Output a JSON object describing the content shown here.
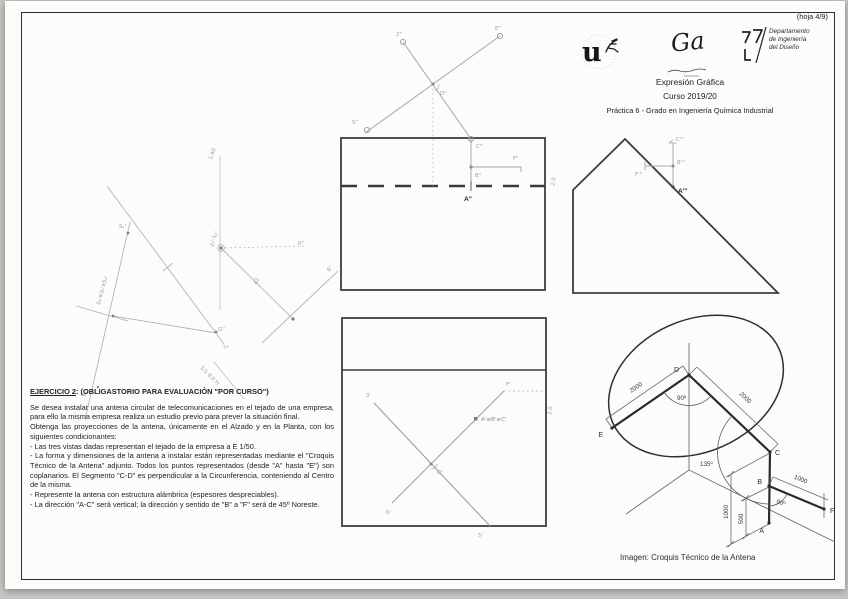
{
  "page": {
    "hoja": "(hoja 4/9)"
  },
  "header": {
    "uni_glyph": "u",
    "mid_glyph": "Ga",
    "dept_line1": "Departamento",
    "dept_line2": "de Ingeniería",
    "dept_line3": "del Diseño",
    "subject": "Expresión Gráfica",
    "course": "Curso 2019/20",
    "practice": "Práctica 6 - Grado en Ingeniería Química Industrial"
  },
  "exercise": {
    "title": "EJERCICIO 2",
    "title_rest": ": (OBLIGASTORIO PARA EVALUACIÓN \"POR CURSO\")",
    "p1": "Se desea instalar una antena circular de telecomunicaciones en el tejado de una empresa, para ello la misma empresa realiza un estudio previo para prever la situación final.",
    "p2": "Obtenga las proyecciones de la antena, únicamente en el Alzado y en la Planta, con los siguientes condicionantes:",
    "b1": "- Las tres vistas dadas representan el tejado de la empresa a E 1/50.",
    "b2": "- La forma y dimensiones de la antena a instalar están representadas mediante el \"Croquis Técnico de la Antena\" adjunto. Todos los puntos representados (desde \"A\" hasta \"E\") son coplanarios. El Segmento \"C-D\" es perpendicular a la Circunferencia, conteniendo al Centro de la misma.",
    "b3": "- Represente la antena con estructura alámbrica (espesores despreciables).",
    "b4": "- La dirección \"A-C\" será vertical; la dirección y sentido de \"B\" a \"F\" será de 45º Noreste."
  },
  "alzado": {
    "a": "A\"",
    "c": "C\"",
    "b": "B\"",
    "f": "F\"",
    "d": "D\"",
    "e": "E\"",
    "n2": "2\"",
    "n5": "5\"",
    "note": "2,0"
  },
  "planta": {
    "abc": "A'≡B'≡C'",
    "f": "F'",
    "d": "D'",
    "e3": "3'",
    "n5": "5'",
    "n6": "6'",
    "note": "2,0"
  },
  "perfil": {
    "a": "A'''",
    "c": "C'''",
    "b": "B'''",
    "f": "F'''"
  },
  "croquis": {
    "caption": "Imagen: Croquis Técnico de la Antena",
    "a": "A",
    "b": "B",
    "c": "C",
    "d": "D",
    "e": "E",
    "f": "F",
    "dim_de": "2000",
    "dim_dc": "2000",
    "dim_bf": "1000",
    "dim_ca": "1000",
    "dim_ab": "500",
    "ang_d": "90º",
    "ang_c": "135º",
    "ang_b": "90º"
  },
  "pencil": {
    "m1": "1,40",
    "m2": "S₂'",
    "m3": "0₄'≡3₄'≡5₄'",
    "m4": "6₄'",
    "m5": "2₄'·1₄'",
    "m6": "0''",
    "m7": "8''",
    "m8": "42",
    "m9": "G''",
    "m10": "1₄",
    "m11": "1/1 8,0 H"
  }
}
